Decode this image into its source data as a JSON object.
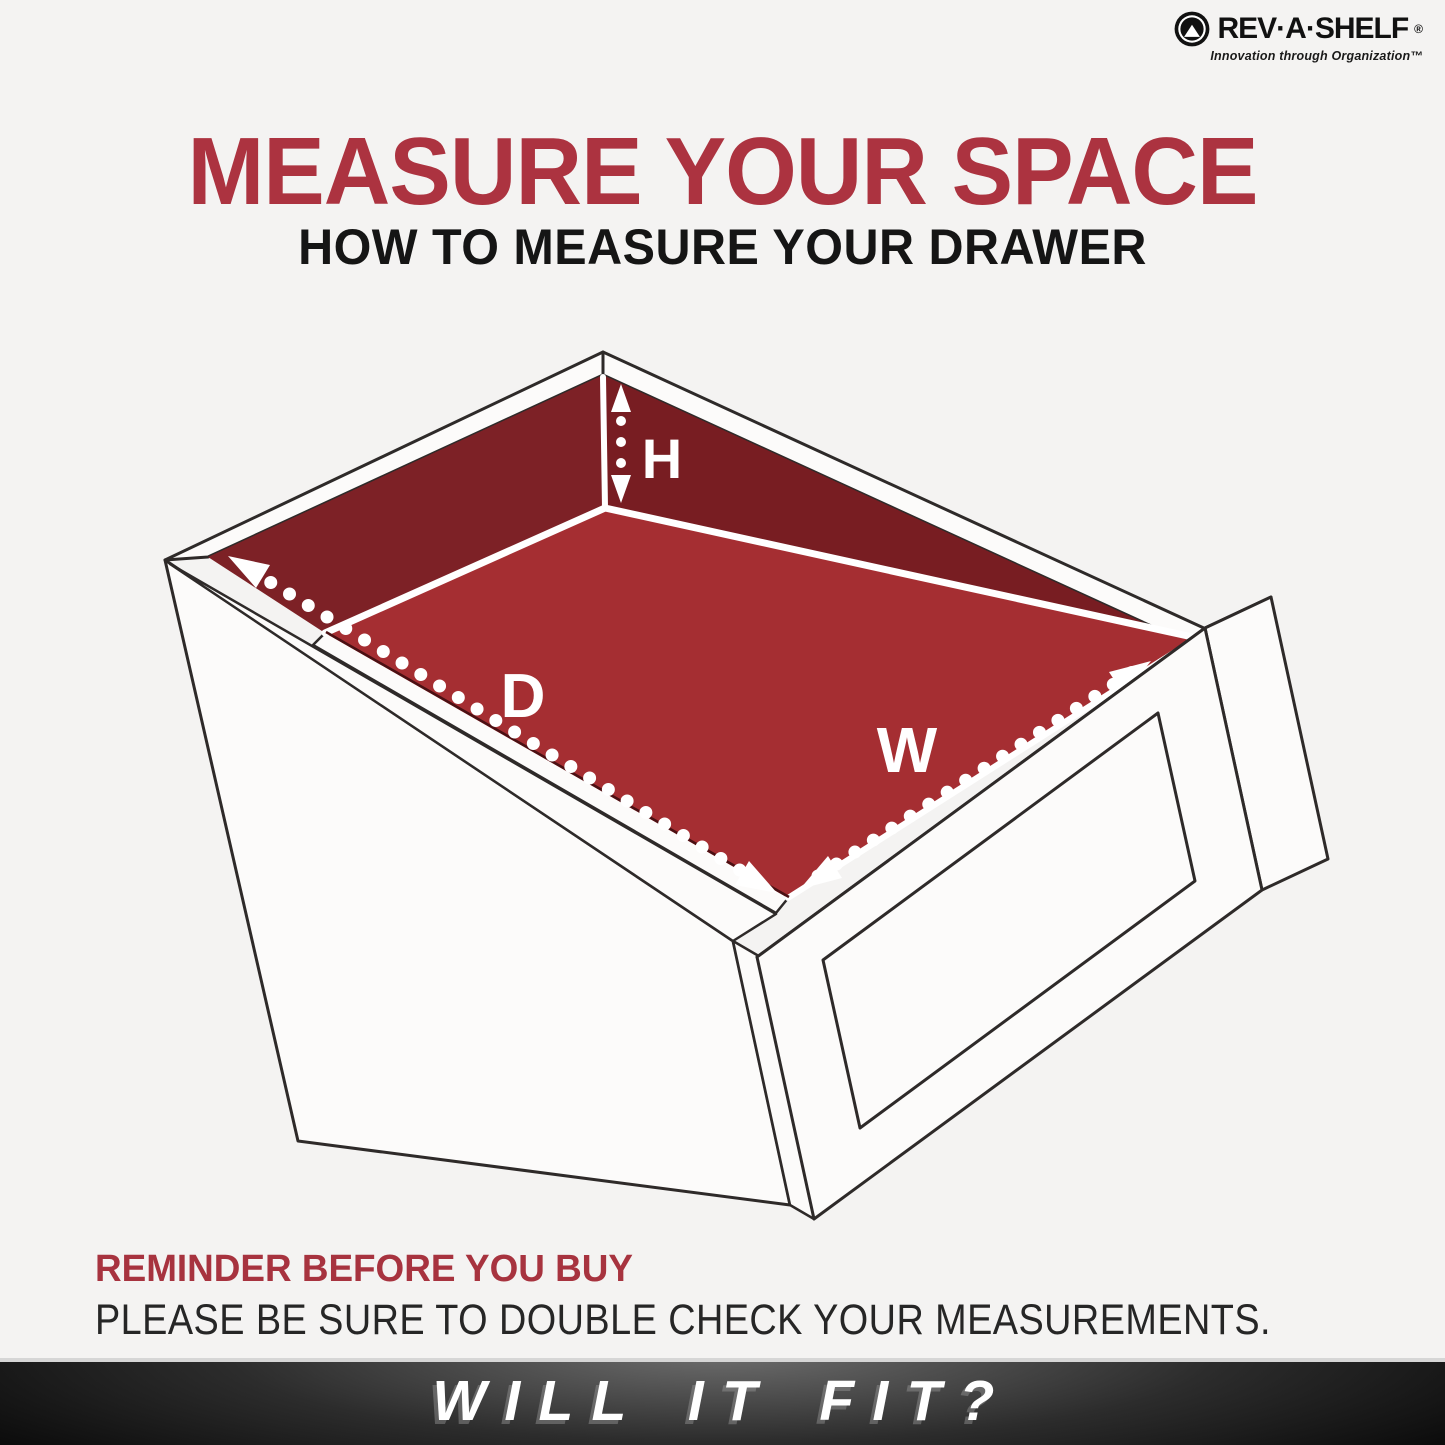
{
  "brand": {
    "name": "REV·A·SHELF",
    "registered_mark": "®",
    "tagline": "Innovation through Organization™",
    "icon": "rev-a-shelf-mountain-logo"
  },
  "header": {
    "title": "MEASURE YOUR SPACE",
    "subtitle": "HOW TO MEASURE YOUR DRAWER"
  },
  "diagram": {
    "type": "isometric-drawer-measurement-illustration",
    "labels": {
      "height": "H",
      "depth": "D",
      "width": "W"
    },
    "colors": {
      "back_wall": "#7d2126",
      "right_wall": "#781d22",
      "floor": "#a52e32",
      "outline": "#2e2a29",
      "measure_marks": "#ffffff"
    }
  },
  "reminder": {
    "heading": "REMINDER BEFORE YOU BUY",
    "body": "PLEASE BE SURE TO DOUBLE CHECK YOUR MEASUREMENTS."
  },
  "banner": {
    "text": "WILL IT FIT?",
    "background": "#141414",
    "text_color": "#ffffff"
  },
  "accent_colors": {
    "title_red": "#ac3340",
    "heading_red": "#a7333f",
    "body_text": "#262626"
  }
}
